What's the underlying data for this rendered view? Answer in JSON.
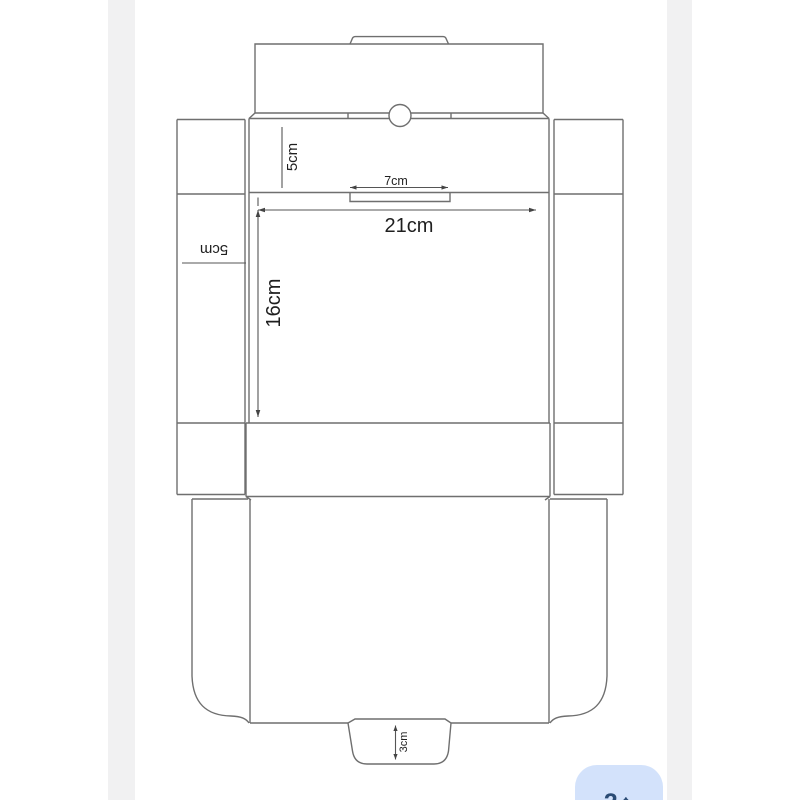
{
  "screen": {
    "background": "#ffffff",
    "photo_margin_color": "#f1f1f2"
  },
  "diagram": {
    "name": "box-dieline-template",
    "line_color": "#6f6f6f",
    "dimension_line_color": "#555555",
    "labels": {
      "lid_front_height": "5cm",
      "tuck_tab_width": "7cm",
      "panel_width": "21cm",
      "panel_height": "16cm",
      "side_flap_width": "5cm",
      "bottom_tab_height": "3cm"
    }
  },
  "overlay_button": {
    "label": "2↑",
    "background": "#d3e2fb",
    "text_color": "#2a4b74"
  }
}
